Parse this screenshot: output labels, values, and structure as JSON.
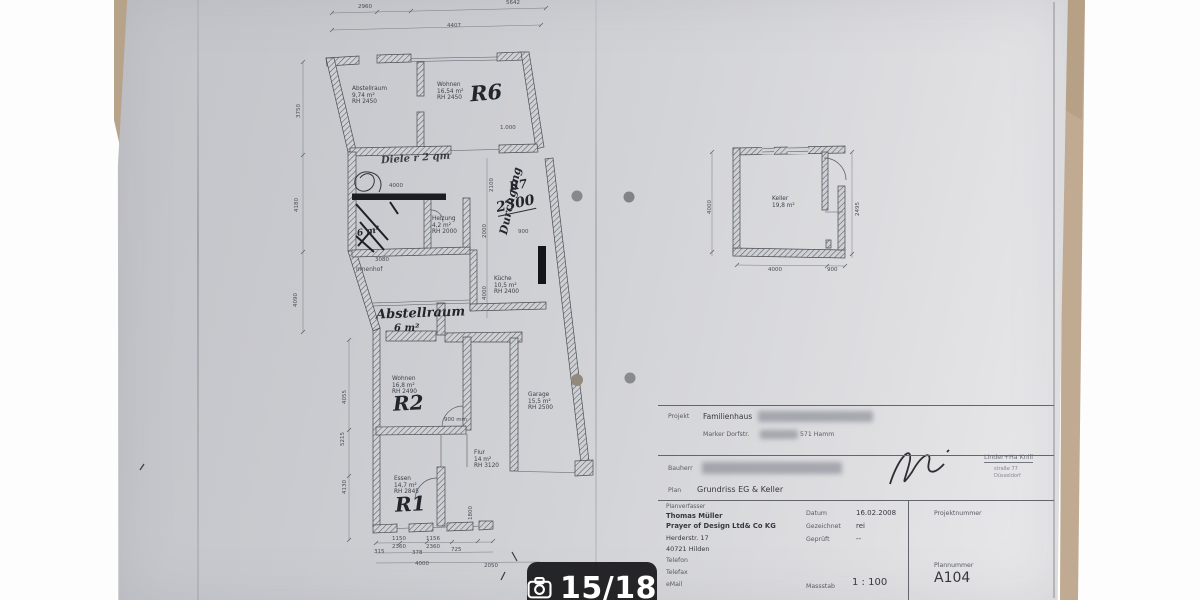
{
  "viewer": {
    "counter": "15/18"
  },
  "colors": {
    "badge_bg": "#1a1a1c",
    "paper": "#cdced2",
    "wood": "#bca689",
    "ink": "#3d4049"
  },
  "plan": {
    "rooms": [
      {
        "name": "Abstellraum",
        "area": "9,74 m²",
        "height": "RH 2450"
      },
      {
        "name": "Wohnen",
        "area": "16,54 m²",
        "height": "RH 2450"
      },
      {
        "name": "Heizung",
        "area": "4,2 m²",
        "height": "RH 2000"
      },
      {
        "name": "Küche",
        "area": "10,5 m²",
        "height": "RH 2400"
      },
      {
        "name": "Wohnen",
        "area": "16,8 m²",
        "height": "RH 2490"
      },
      {
        "name": "Garage",
        "area": "15,5 m²",
        "height": "RH 2500"
      },
      {
        "name": "Flur",
        "area": "14 m²",
        "height": "RH 3120"
      },
      {
        "name": "Essen",
        "area": "14,7 m²",
        "height": "RH 2845"
      },
      {
        "name": "Keller",
        "area": "19,8 m²",
        "height": ""
      }
    ],
    "labels": {
      "innenhof": "Innenhof"
    },
    "handwritten": {
      "r6": "R6",
      "r7": "R7",
      "r2": "R2",
      "r1": "R1",
      "n2300": "2300",
      "durchgang": "Durchgang",
      "abstellraum": "Abstellraum",
      "qm6": "6 m²",
      "wc6": "6 m²",
      "hall_note": "Diele r 2 qm"
    },
    "dims": {
      "top1": "2960",
      "top2": "5642",
      "top3": "4407",
      "left1": "3750",
      "left2": "4180",
      "left3": "4090",
      "li1": "4055",
      "li2": "5215",
      "li3": "4130",
      "b1": "1150",
      "b2": "2360",
      "b3": "1156",
      "b4": "2360",
      "b5": "725",
      "b6": "315",
      "b7": "378",
      "b8": "4000",
      "b9": "2050",
      "v1800": "1800",
      "v2100": "2100",
      "v2000": "2000",
      "v4000": "4000",
      "d1000": "1.000",
      "d900": "900",
      "d3080": "3080",
      "d4000": "4000",
      "door900": "900 mm",
      "k4000": "4000",
      "k900": "900",
      "k2495": "2495",
      "k4000l": "4000"
    }
  },
  "titleblock": {
    "projekt_label": "Projekt",
    "projekt_value": "Familienhaus",
    "addr_street": "Marker Dorfstr.",
    "addr_city": "571 Hamm",
    "bauherr_label": "Bauherr",
    "plan_label": "Plan",
    "plan_value": "Grundriss EG & Keller",
    "planverfasser_label": "Planverfasser",
    "author1": "Thomas Müller",
    "author2": "Prayer of Design Ltd& Co KG",
    "author3": "Herderstr. 17",
    "author4": "40721 Hilden",
    "tel_label": "Telefon",
    "fax_label": "Telefax",
    "mail_label": "eMail",
    "datum_label": "Datum",
    "datum_value": "16.02.2008",
    "gezeichnet_label": "Gezeichnet",
    "gezeichnet_value": "rei",
    "geprueft_label": "Geprüft",
    "geprueft_value": "--",
    "massstab_label": "Massstab",
    "massstab_value": "1 : 100",
    "projektnummer_label": "Projektnummer",
    "plannummer_label": "Plannummer",
    "plannummer_value": "A104",
    "stamp_line1": "Linder+Ha Knill",
    "stamp_line2": "straße 77",
    "stamp_line3": "Düsseldorf"
  }
}
